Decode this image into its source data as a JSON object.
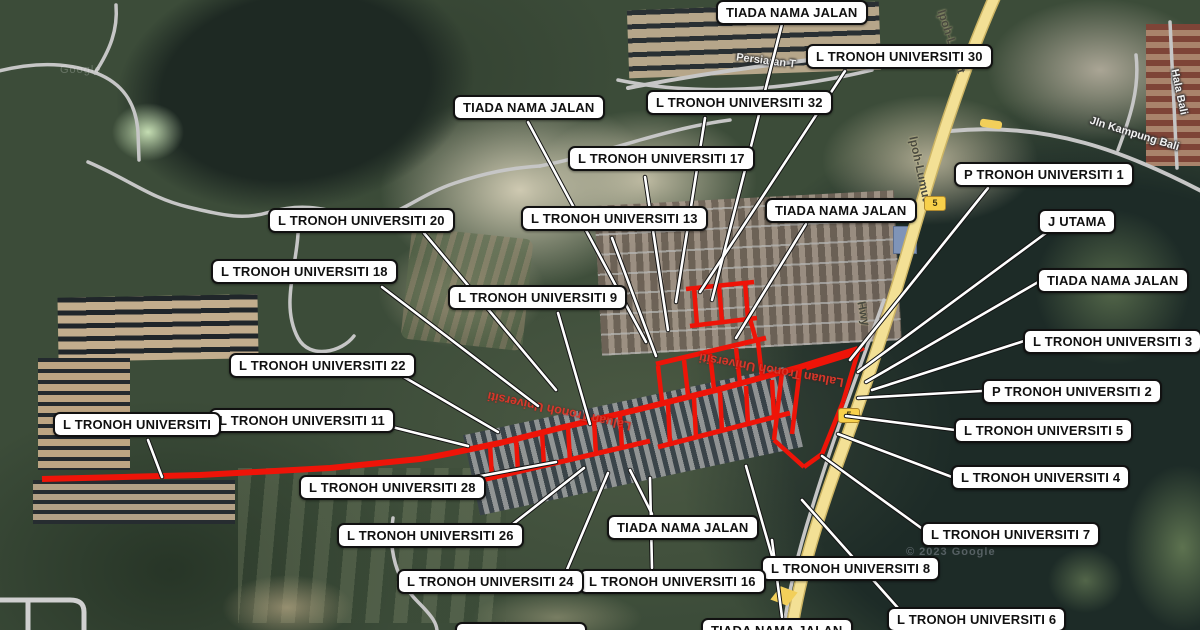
{
  "map": {
    "route_shield": "5",
    "watermark_main": "© 2023 Google",
    "watermark_tile": "Google",
    "street_names": {
      "persiaran": "Persiaran T",
      "laluan_tronoh": "Laluan Tronoh Universiti",
      "ipoh_lumut": "Ipoh-Lumut",
      "hwy": "Hwy",
      "jln_kampung_bali": "Jln Kampung Bali",
      "hala_bali": "Hala Bali"
    },
    "colors": {
      "road_highlight": "#ee1408",
      "highway_fill": "#f3e095",
      "label_bg": "#ffffff",
      "label_border": "#111111"
    }
  },
  "labels": [
    {
      "id": "tiada-nama-jalan-top",
      "text": "TIADA NAMA JALAN"
    },
    {
      "id": "l-tronoh-universiti-30",
      "text": "L TRONOH UNIVERSITI 30"
    },
    {
      "id": "l-tronoh-universiti-32",
      "text": "L TRONOH UNIVERSITI 32"
    },
    {
      "id": "tiada-nama-jalan-a",
      "text": "TIADA NAMA JALAN"
    },
    {
      "id": "l-tronoh-universiti-17",
      "text": "L TRONOH UNIVERSITI 17"
    },
    {
      "id": "l-tronoh-universiti-13",
      "text": "L TRONOH UNIVERSITI 13"
    },
    {
      "id": "tiada-nama-jalan-b",
      "text": "TIADA NAMA JALAN"
    },
    {
      "id": "l-tronoh-universiti-20",
      "text": "L TRONOH UNIVERSITI 20"
    },
    {
      "id": "p-tronoh-universiti-1",
      "text": "P TRONOH UNIVERSITI 1"
    },
    {
      "id": "j-utama",
      "text": "J UTAMA"
    },
    {
      "id": "l-tronoh-universiti-18",
      "text": "L TRONOH UNIVERSITI 18"
    },
    {
      "id": "tiada-nama-jalan-c",
      "text": "TIADA NAMA JALAN"
    },
    {
      "id": "l-tronoh-universiti-9",
      "text": "L TRONOH UNIVERSITI 9"
    },
    {
      "id": "l-tronoh-universiti-3",
      "text": "L TRONOH UNIVERSITI 3"
    },
    {
      "id": "l-tronoh-universiti-22",
      "text": "L TRONOH UNIVERSITI 22"
    },
    {
      "id": "p-tronoh-universiti-2",
      "text": "P TRONOH UNIVERSITI 2"
    },
    {
      "id": "l-tronoh-universiti-11",
      "text": "L TRONOH UNIVERSITI 11"
    },
    {
      "id": "l-tronoh-universiti",
      "text": "L TRONOH UNIVERSITI"
    },
    {
      "id": "l-tronoh-universiti-5",
      "text": "L TRONOH UNIVERSITI 5"
    },
    {
      "id": "l-tronoh-universiti-4",
      "text": "L TRONOH UNIVERSITI 4"
    },
    {
      "id": "l-tronoh-universiti-28",
      "text": "L TRONOH UNIVERSITI 28"
    },
    {
      "id": "l-tronoh-universiti-7",
      "text": "L TRONOH UNIVERSITI 7"
    },
    {
      "id": "tiada-nama-jalan-d",
      "text": "TIADA NAMA JALAN"
    },
    {
      "id": "l-tronoh-universiti-26",
      "text": "L TRONOH UNIVERSITI 26"
    },
    {
      "id": "l-tronoh-universiti-8",
      "text": "L TRONOH UNIVERSITI 8"
    },
    {
      "id": "l-tronoh-universiti-16",
      "text": "L TRONOH UNIVERSITI 16"
    },
    {
      "id": "l-tronoh-universiti-24",
      "text": "L TRONOH UNIVERSITI 24"
    },
    {
      "id": "l-tronoh-universiti-6",
      "text": "L TRONOH UNIVERSITI 6"
    },
    {
      "id": "label-bottom-partial",
      "text": ""
    },
    {
      "id": "tiada-nama-jalan-e",
      "text": "TIADA NAMA JALAN"
    }
  ]
}
